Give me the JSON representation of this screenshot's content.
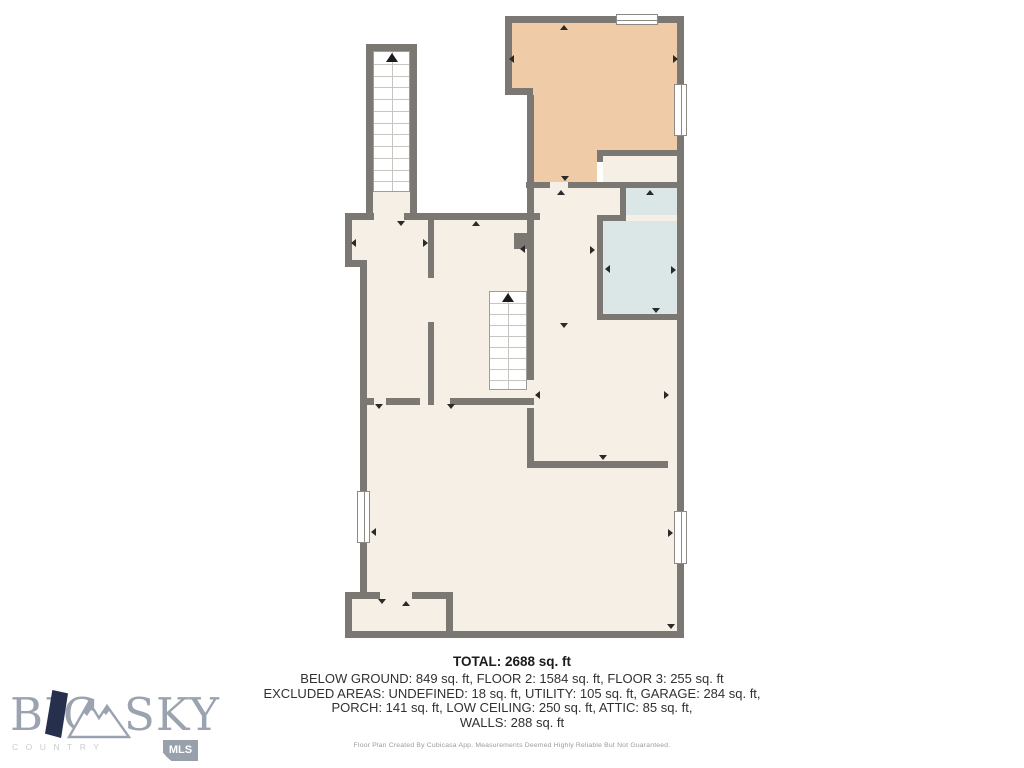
{
  "floorplan": {
    "rooms": {
      "bedroom": {
        "name": "Bedroom",
        "dims": "12'5\" x 12'4\""
      },
      "hall_upper": {
        "name": "Hall",
        "dims": "'11\" x 10'10\""
      },
      "bath": {
        "name": "Bath",
        "dims": "5'9\" x 10'6\""
      },
      "hall_left": {
        "name": "Hall",
        "dims": "6'1\" x 14'1\""
      },
      "utility": {
        "name": "Utility",
        "dims": "7'8\" x 14'1\""
      },
      "kitchen": {
        "name": "Kitchen",
        "dims": "10'3\" x 10'10\""
      },
      "recreation": {
        "name": "Recreation Room",
        "dims": "23'5\" x 23'11\""
      }
    },
    "colors": {
      "wall": "#7b7874",
      "floor": "#f6efe6",
      "bedroom": "#f0cba8",
      "bath": "#dbe7e7",
      "stairs": "#ffffff"
    }
  },
  "summary": {
    "total": "TOTAL: 2688 sq. ft",
    "line1": "BELOW GROUND: 849 sq. ft, FLOOR 2: 1584 sq. ft, FLOOR 3: 255 sq. ft",
    "line2": "EXCLUDED AREAS: UNDEFINED: 18 sq. ft, UTILITY: 105 sq. ft, GARAGE: 284 sq. ft,",
    "line3": "PORCH: 141 sq. ft, LOW CEILING: 250 sq. ft, ATTIC: 85 sq. ft,",
    "line4": "WALLS: 288 sq. ft",
    "disclaimer": "Floor Plan Created By Cubicasa App. Measurements Deemed Highly Reliable But Not Guaranteed."
  },
  "logo": {
    "word1": "BIG",
    "word2": "SKY",
    "subtitle": "COUNTRY",
    "badge": "MLS"
  }
}
